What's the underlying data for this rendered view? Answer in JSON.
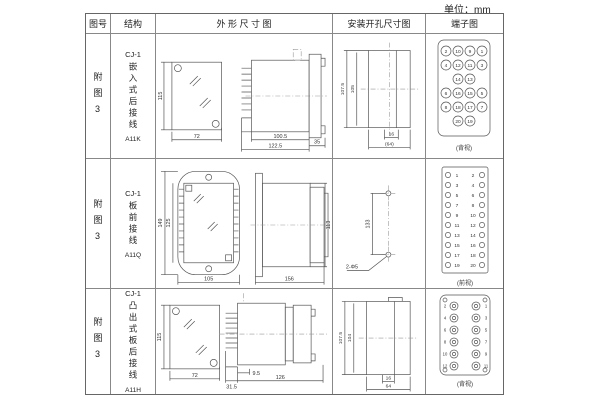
{
  "unit_label": "单位：mm",
  "header": {
    "fig_no": "图号",
    "structure": "结构",
    "outline": "外 形 尺 寸 图",
    "install": "安装开孔尺寸图",
    "terminal": "端子图"
  },
  "rows": [
    {
      "fig_no": "附图3",
      "series": "CJ-1",
      "structure": "嵌入式后接线",
      "model": "A11K",
      "outline": {
        "front_h": "115",
        "front_w": "72",
        "len_inner": "100.5",
        "len_outer": "122.5",
        "flange": "35"
      },
      "install": {
        "v_outer": "107.5",
        "v_inner": "105",
        "h_inner": "16",
        "h_outer": "(64)"
      },
      "terminal": {
        "view": "(背视)",
        "grid": [
          [
            "2",
            "10",
            "9",
            "1"
          ],
          [
            "4",
            "12",
            "11",
            "3"
          ],
          [
            "",
            "14",
            "13",
            ""
          ],
          [
            "6",
            "16",
            "15",
            "5"
          ],
          [
            "8",
            "18",
            "17",
            "7"
          ],
          [
            "",
            "20",
            "19",
            ""
          ]
        ]
      }
    },
    {
      "fig_no": "附图3",
      "series": "CJ-1",
      "structure": "板前接线",
      "model": "A11Q",
      "outline": {
        "front_h_outer": "149",
        "front_h_inner": "125",
        "front_w": "105",
        "side_len": "156",
        "side_h": "113"
      },
      "install": {
        "v": "133",
        "holes": "2-Φ5"
      },
      "terminal": {
        "view": "(前视)",
        "left": [
          "1",
          "3",
          "5",
          "7",
          "9",
          "11",
          "13",
          "15",
          "17",
          "19"
        ],
        "right": [
          "2",
          "4",
          "6",
          "8",
          "10",
          "12",
          "14",
          "16",
          "18",
          "20"
        ]
      }
    },
    {
      "fig_no": "附图3",
      "series": "CJ-1",
      "structure": "凸出式板后接线",
      "model": "A11H",
      "outline": {
        "front_h": "115",
        "front_w": "72",
        "pin_len": "31.5",
        "offset": "9.5",
        "body_len": "126"
      },
      "install": {
        "v_outer": "107.5",
        "v_inner": "104",
        "h_inner": "16",
        "h_outer": "64"
      },
      "terminal": {
        "view": "(背视)",
        "left": [
          "2",
          "4",
          "6",
          "8",
          "10",
          "12"
        ],
        "right": [
          "1",
          "3",
          "5",
          "7",
          "9",
          "11"
        ]
      }
    }
  ]
}
